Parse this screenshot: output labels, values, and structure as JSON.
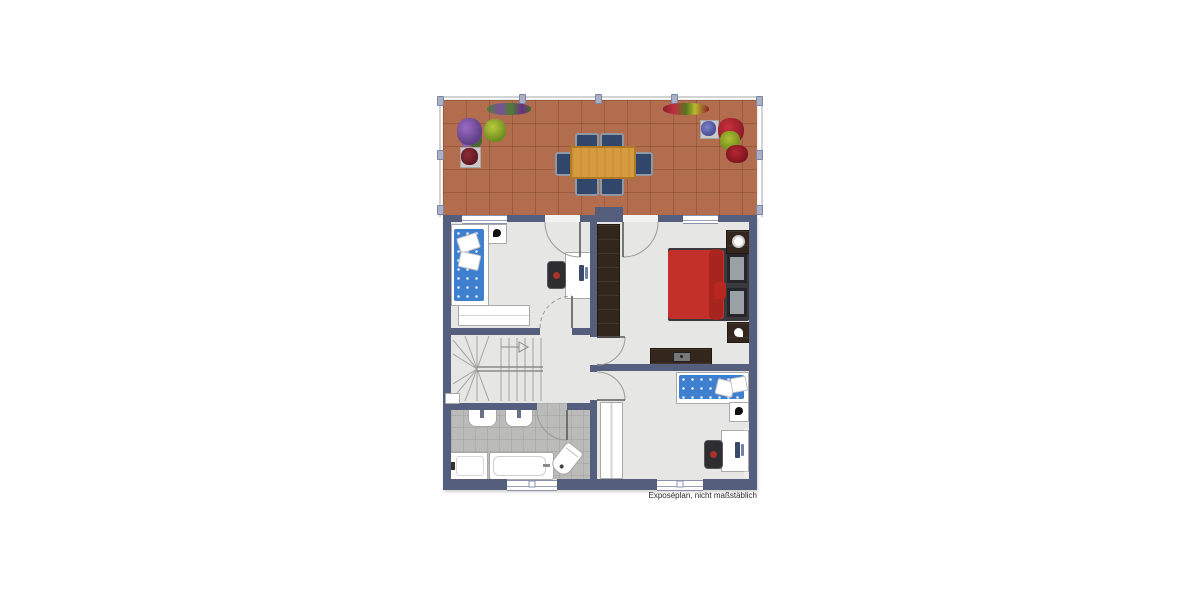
{
  "disclaimer": "Exposéplan, nicht maßstäblich",
  "palette": {
    "wall": "#565e7d",
    "floor": "#e6e6e4",
    "bathroom_floor": "#bbbbb9",
    "terrace_tile": "#b26d4e",
    "table_wood": "#d79b3f",
    "bed_blue": "#3f7fd0",
    "bed_red": "#c23029",
    "dark_wood": "#33271d",
    "railing": "#d2d2d2"
  },
  "terrace": {
    "dining_chairs": 6,
    "items": [
      "wooden-dining-table",
      "six-chairs",
      "flower-pots",
      "railing"
    ]
  },
  "rooms": {
    "bedroom_top_left": [
      "single-bed-blue",
      "nightstand-lamp",
      "desk-laptop",
      "office-chair",
      "dresser"
    ],
    "bedroom_master": [
      "double-bed-red",
      "wardrobe-dark",
      "nightstand-lamp",
      "nightstand",
      "sideboard-tv"
    ],
    "bedroom_bottom_right": [
      "single-bed-blue",
      "nightstand-lamp",
      "wardrobe-white",
      "desk-laptop",
      "office-chair"
    ],
    "bathroom": [
      "washbasin",
      "washbasin",
      "bathtub",
      "shower-tray",
      "toilet"
    ],
    "hall": [
      "winder-staircase"
    ]
  }
}
